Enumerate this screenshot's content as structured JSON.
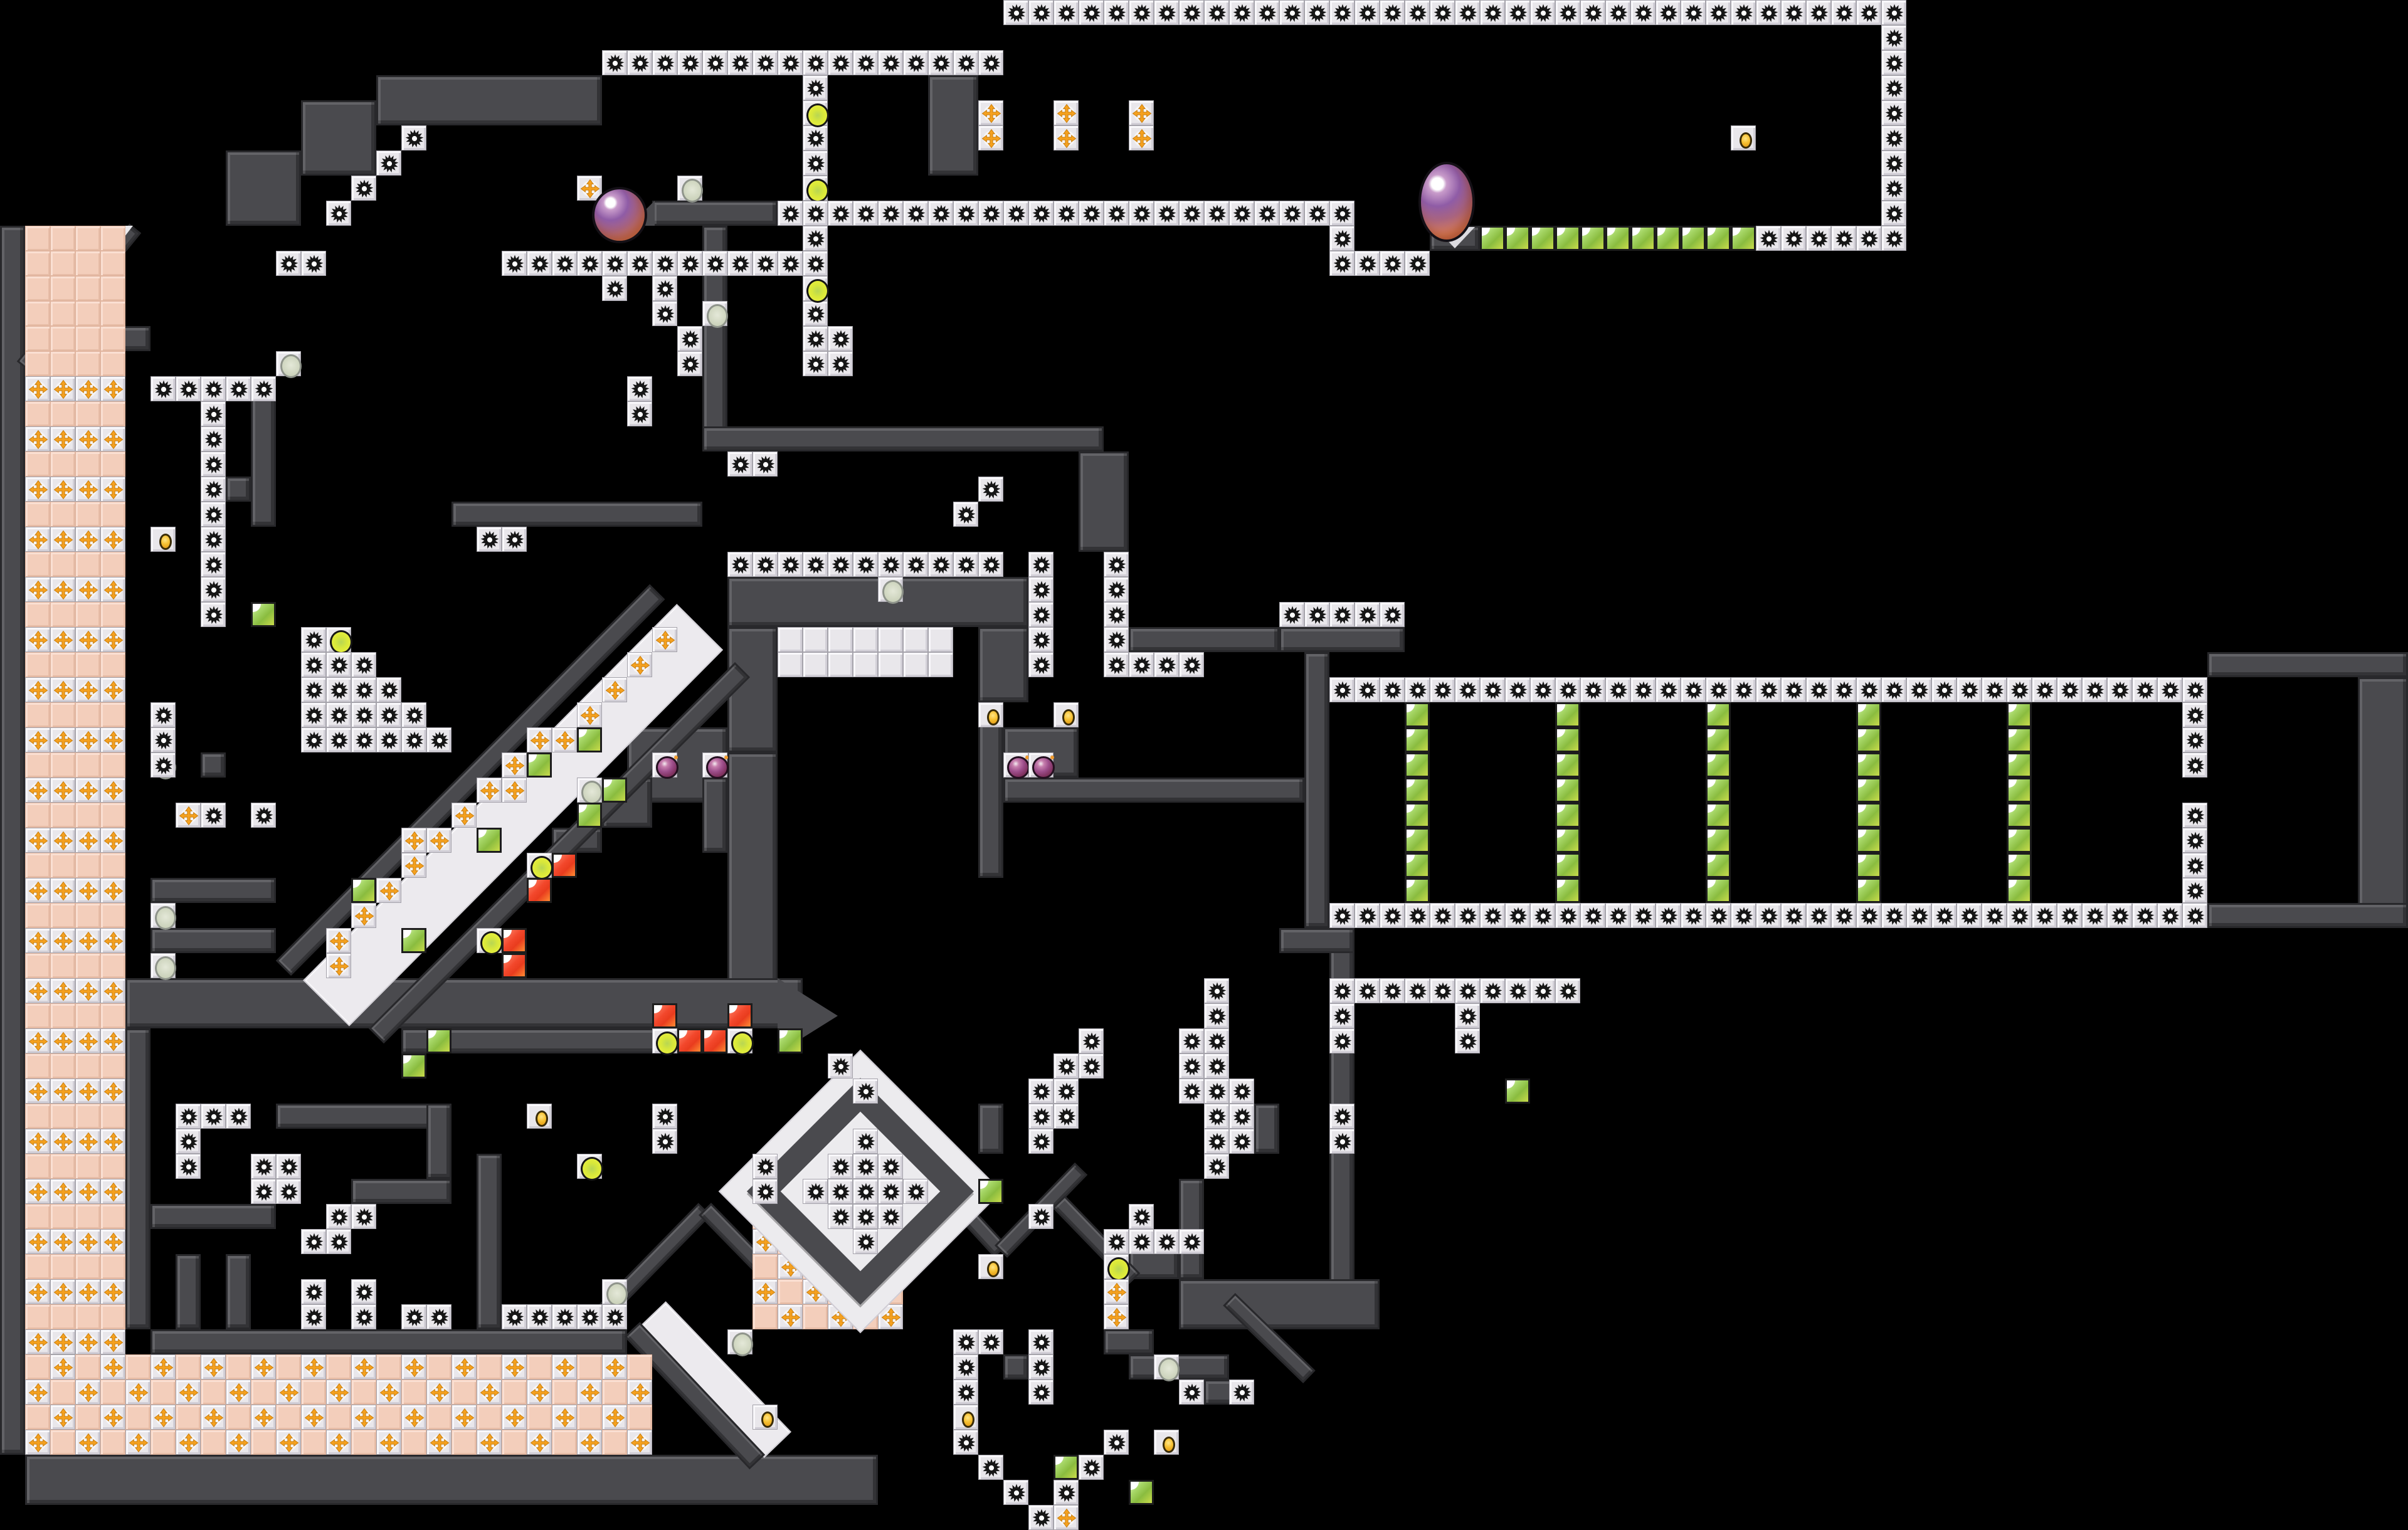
{
  "map": {
    "tile_size": 40,
    "grid": {
      "cols": 96,
      "rows": 61
    },
    "colors": {
      "background": "#000000",
      "wall": "#4a4a4e",
      "wall_edge": "#28282b",
      "tile_base": "#e9e7eb",
      "gear": "#161616",
      "pink": "#f3cebb",
      "cross": "#f5a11f",
      "green_block": "#8abc3f",
      "red_block": "#ee3b22",
      "yellow_orb": "#e3ee3b",
      "gray_orb": "#ccd3bc",
      "gold_item": "#f6c133",
      "plum_enemy": "#9c4d8a",
      "big_orb_purple": "#8f5ca6",
      "big_orb_orange": "#dd7f58"
    },
    "legend": {
      "g": "gear-block-tile",
      "w": "white-tile",
      "pk": "pink-tile",
      "p": "cross-spike-tile",
      "gr": "green-item-block",
      "rd": "red-item-block",
      "yo": "yellow-orb-tile",
      "so": "gray-orb-tile",
      "gd": "gold-item-tile",
      "pl": "plum-enemy-tile"
    },
    "walls": [
      [
        15,
        3,
        9,
        2
      ],
      [
        12,
        4,
        3,
        3
      ],
      [
        9,
        6,
        3,
        3
      ],
      [
        37,
        3,
        2,
        4
      ],
      [
        26,
        8,
        5,
        1
      ],
      [
        57,
        9,
        2,
        1
      ],
      [
        28,
        9,
        1,
        9
      ],
      [
        28,
        17,
        16,
        1
      ],
      [
        43,
        18,
        2,
        4
      ],
      [
        18,
        20,
        10,
        1
      ],
      [
        29,
        23,
        12,
        2
      ],
      [
        29,
        25,
        2,
        5
      ],
      [
        39,
        25,
        2,
        3
      ],
      [
        29,
        30,
        2,
        10
      ],
      [
        25,
        29,
        4,
        3
      ],
      [
        28,
        31,
        1,
        3
      ],
      [
        39,
        28,
        1,
        7
      ],
      [
        40,
        29,
        3,
        2
      ],
      [
        40,
        31,
        12,
        1
      ],
      [
        45,
        25,
        6,
        1
      ],
      [
        51,
        25,
        5,
        1
      ],
      [
        52,
        26,
        1,
        11
      ],
      [
        88,
        26,
        8,
        1
      ],
      [
        94,
        27,
        2,
        10
      ],
      [
        88,
        36,
        8,
        1
      ],
      [
        53,
        37,
        1,
        15
      ],
      [
        51,
        37,
        3,
        1
      ],
      [
        47,
        51,
        8,
        2
      ],
      [
        47,
        47,
        1,
        4
      ],
      [
        45,
        49,
        2,
        2
      ],
      [
        5,
        39,
        27,
        2
      ],
      [
        16,
        41,
        14,
        1
      ],
      [
        0,
        9,
        1,
        49
      ],
      [
        2,
        13,
        4,
        1
      ],
      [
        10,
        15,
        1,
        6
      ],
      [
        9,
        19,
        1,
        1
      ],
      [
        8,
        30,
        1,
        1
      ],
      [
        6,
        35,
        5,
        1
      ],
      [
        6,
        37,
        5,
        1
      ],
      [
        6,
        53,
        19,
        1
      ],
      [
        7,
        50,
        1,
        3
      ],
      [
        9,
        50,
        1,
        3
      ],
      [
        1,
        58,
        34,
        2
      ],
      [
        11,
        44,
        7,
        1
      ],
      [
        17,
        44,
        1,
        3
      ],
      [
        14,
        47,
        4,
        1
      ],
      [
        5,
        41,
        1,
        12
      ],
      [
        6,
        48,
        5,
        1
      ],
      [
        19,
        46,
        1,
        7
      ],
      [
        24,
        31,
        2,
        2
      ],
      [
        22,
        33,
        2,
        1
      ],
      [
        38,
        47,
        1,
        1
      ],
      [
        40,
        54,
        1,
        1
      ],
      [
        44,
        53,
        2,
        1
      ],
      [
        45,
        54,
        4,
        1
      ],
      [
        48,
        55,
        2,
        1
      ],
      [
        39,
        44,
        1,
        2
      ],
      [
        50,
        44,
        1,
        2
      ]
    ],
    "diagonals": [
      {
        "x1": 13.0,
        "y1": 40.0,
        "x2": 27.9,
        "y2": 25.0,
        "th": 2.6,
        "c": "white"
      },
      {
        "x1": 11.3,
        "y1": 38.6,
        "x2": 26.2,
        "y2": 23.6,
        "th": 0.85
      },
      {
        "x1": 15.0,
        "y1": 41.3,
        "x2": 29.6,
        "y2": 26.7,
        "th": 0.85
      },
      {
        "x1": 26.0,
        "y1": 52.4,
        "x2": 31.0,
        "y2": 57.6,
        "th": 1.5,
        "c": "white"
      },
      {
        "x1": 25.2,
        "y1": 53.0,
        "x2": 30.2,
        "y2": 58.3,
        "th": 0.85
      },
      {
        "x1": 0.9,
        "y1": 14.6,
        "x2": 5.4,
        "y2": 9.1,
        "th": 0.6
      },
      {
        "x1": 23.6,
        "y1": 52.8,
        "x2": 28.1,
        "y2": 48.2,
        "th": 0.7
      },
      {
        "x1": 28.1,
        "y1": 48.2,
        "x2": 32.4,
        "y2": 52.6,
        "th": 0.7
      },
      {
        "x1": 36.6,
        "y1": 46.3,
        "x2": 39.9,
        "y2": 49.9,
        "th": 0.7
      },
      {
        "x1": 39.9,
        "y1": 49.9,
        "x2": 43.1,
        "y2": 46.6,
        "th": 0.7
      },
      {
        "x1": 49.0,
        "y1": 51.8,
        "x2": 52.2,
        "y2": 54.9,
        "th": 0.7
      },
      {
        "x1": 42.2,
        "y1": 47.9,
        "x2": 45.2,
        "y2": 51.0,
        "th": 0.7
      }
    ],
    "triangles": [
      {
        "x": 1,
        "y": 9,
        "w": 4.3,
        "h": 5.6,
        "clip": "polygon(0 0,100% 0,0 100%)",
        "c": "#ecebee"
      },
      {
        "x": 57.2,
        "y": 9.05,
        "w": 1.6,
        "h": 0.85,
        "clip": "polygon(0 0,100% 0,50% 100%)",
        "c": "#dcdbe0"
      },
      {
        "x": 31,
        "y": 39,
        "w": 2.4,
        "h": 3,
        "clip": "polygon(0 0,100% 50%,0 100%)",
        "c": "#4a4a4e"
      },
      {
        "x": 25.1,
        "y": 8,
        "w": 1,
        "h": 1,
        "clip": "polygon(100% 0,100% 100%,0 100%)",
        "c": "#4a4a4e"
      }
    ],
    "pink_column": {
      "x": 1,
      "y": 9,
      "w": 4,
      "h": 45,
      "plus_rows_start": 15,
      "plus_rows_step": 2
    },
    "checkers": [
      {
        "x": 1,
        "y": 54,
        "w": 25,
        "h": 4,
        "phase": 0
      },
      {
        "x": 30,
        "y": 48,
        "w": 6,
        "h": 5,
        "phase": 1
      }
    ],
    "diamond": {
      "cx": 34.3,
      "cy": 47.5,
      "back": 8.0,
      "ring": 6.4,
      "ring_border": 0.95
    },
    "tiles": [
      [
        "g",
        40,
        0,
        36,
        "h"
      ],
      [
        "g",
        75,
        1,
        8,
        "v"
      ],
      [
        "g",
        24,
        2,
        16,
        "h"
      ],
      [
        "g",
        32,
        3,
        12,
        "v"
      ],
      [
        "yo",
        32,
        4
      ],
      [
        "yo",
        32,
        7
      ],
      [
        "yo",
        32,
        11
      ],
      [
        "g",
        33,
        13,
        2,
        "v"
      ],
      [
        "p",
        39,
        4
      ],
      [
        "p",
        39,
        5
      ],
      [
        "p",
        42,
        4
      ],
      [
        "p",
        42,
        5
      ],
      [
        "p",
        45,
        4
      ],
      [
        "p",
        45,
        5
      ],
      [
        "gd",
        69,
        5
      ],
      [
        "g",
        31,
        8,
        23,
        "h"
      ],
      [
        "g",
        53,
        9
      ],
      [
        "g",
        53,
        10,
        4,
        "h"
      ],
      [
        "gr",
        59,
        9,
        11,
        "h"
      ],
      [
        "g",
        70,
        9,
        6,
        "h"
      ],
      [
        "g",
        16,
        5
      ],
      [
        "g",
        15,
        6
      ],
      [
        "g",
        14,
        7
      ],
      [
        "g",
        13,
        8
      ],
      [
        "g",
        11,
        10,
        2,
        "h"
      ],
      [
        "p",
        23,
        7
      ],
      [
        "so",
        27,
        7
      ],
      [
        "g",
        20,
        10,
        12,
        "h"
      ],
      [
        "g",
        24,
        11
      ],
      [
        "g",
        26,
        11,
        2,
        "v"
      ],
      [
        "g",
        27,
        13,
        2,
        "v"
      ],
      [
        "g",
        25,
        15,
        2,
        "v"
      ],
      [
        "so",
        28,
        12
      ],
      [
        "g",
        29,
        18,
        2,
        "h"
      ],
      [
        "g",
        19,
        21,
        2,
        "h"
      ],
      [
        "g",
        38,
        20
      ],
      [
        "g",
        39,
        19
      ],
      [
        "so",
        35,
        23
      ],
      [
        "g",
        29,
        22,
        11,
        "h"
      ],
      [
        "w",
        31,
        25,
        7,
        "h"
      ],
      [
        "w",
        31,
        26,
        7,
        "h"
      ],
      [
        "g",
        41,
        22,
        5,
        "v"
      ],
      [
        "g",
        44,
        22,
        5,
        "v"
      ],
      [
        "g",
        45,
        26,
        3,
        "h"
      ],
      [
        "g",
        51,
        24,
        5,
        "h"
      ],
      [
        "gd",
        39,
        28
      ],
      [
        "gd",
        42,
        28
      ],
      [
        "pl",
        26,
        30
      ],
      [
        "pl",
        28,
        30
      ],
      [
        "pl",
        40,
        30
      ],
      [
        "pl",
        41,
        30
      ],
      [
        "g",
        53,
        27,
        35,
        "h"
      ],
      [
        "g",
        53,
        36,
        35,
        "h"
      ],
      [
        "gr",
        56,
        28,
        8,
        "v"
      ],
      [
        "gr",
        62,
        28,
        8,
        "v"
      ],
      [
        "gr",
        68,
        28,
        8,
        "v"
      ],
      [
        "gr",
        74,
        28,
        8,
        "v"
      ],
      [
        "gr",
        80,
        28,
        8,
        "v"
      ],
      [
        "g",
        87,
        28,
        3,
        "v"
      ],
      [
        "g",
        87,
        32,
        4,
        "v"
      ],
      [
        "g",
        53,
        39,
        10,
        "h"
      ],
      [
        "g",
        53,
        40,
        2,
        "v"
      ],
      [
        "g",
        58,
        40,
        2,
        "v"
      ],
      [
        "g",
        53,
        44,
        2,
        "v"
      ],
      [
        "gr",
        60,
        43
      ],
      [
        "g",
        48,
        39,
        2,
        "v"
      ],
      [
        "g",
        43,
        41
      ],
      [
        "g",
        47,
        41
      ],
      [
        "g",
        48,
        41
      ],
      [
        "g",
        42,
        42
      ],
      [
        "g",
        43,
        42
      ],
      [
        "g",
        47,
        42
      ],
      [
        "g",
        48,
        42
      ],
      [
        "g",
        41,
        43
      ],
      [
        "g",
        42,
        43
      ],
      [
        "g",
        47,
        43
      ],
      [
        "g",
        48,
        43
      ],
      [
        "g",
        49,
        43
      ],
      [
        "g",
        41,
        44
      ],
      [
        "g",
        42,
        44
      ],
      [
        "g",
        48,
        44
      ],
      [
        "g",
        49,
        44
      ],
      [
        "g",
        41,
        45
      ],
      [
        "g",
        48,
        45
      ],
      [
        "g",
        49,
        45
      ],
      [
        "g",
        48,
        46
      ],
      [
        "g",
        41,
        48
      ],
      [
        "g",
        45,
        48
      ],
      [
        "g",
        44,
        49,
        4,
        "h"
      ],
      [
        "yo",
        44,
        50
      ],
      [
        "p",
        44,
        51
      ],
      [
        "p",
        44,
        52
      ],
      [
        "so",
        46,
        54
      ],
      [
        "g",
        47,
        55
      ],
      [
        "g",
        49,
        55
      ],
      [
        "g",
        38,
        53
      ],
      [
        "g",
        39,
        53
      ],
      [
        "g",
        38,
        54
      ],
      [
        "g",
        38,
        55
      ],
      [
        "g",
        41,
        53,
        3,
        "v"
      ],
      [
        "gr",
        42,
        58
      ],
      [
        "gr",
        45,
        59
      ],
      [
        "gd",
        46,
        57
      ],
      [
        "g",
        38,
        57
      ],
      [
        "g",
        39,
        58
      ],
      [
        "g",
        40,
        59
      ],
      [
        "g",
        41,
        60
      ],
      [
        "g",
        42,
        59
      ],
      [
        "g",
        43,
        58
      ],
      [
        "g",
        44,
        57
      ],
      [
        "p",
        42,
        60
      ],
      [
        "gr",
        23,
        29
      ],
      [
        "gr",
        21,
        30
      ],
      [
        "so",
        23,
        31
      ],
      [
        "gr",
        24,
        31
      ],
      [
        "gr",
        23,
        32
      ],
      [
        "gr",
        19,
        33
      ],
      [
        "yo",
        21,
        34
      ],
      [
        "rd",
        22,
        34
      ],
      [
        "rd",
        21,
        35
      ],
      [
        "gr",
        14,
        35
      ],
      [
        "gr",
        16,
        37
      ],
      [
        "yo",
        19,
        37
      ],
      [
        "rd",
        20,
        37
      ],
      [
        "rd",
        20,
        38
      ],
      [
        "gr",
        17,
        41
      ],
      [
        "gr",
        16,
        42
      ],
      [
        "rd",
        26,
        40
      ],
      [
        "rd",
        29,
        40
      ],
      [
        "yo",
        26,
        41
      ],
      [
        "rd",
        27,
        41
      ],
      [
        "rd",
        28,
        41
      ],
      [
        "yo",
        29,
        41
      ],
      [
        "gr",
        31,
        41
      ],
      [
        "gd",
        21,
        44
      ],
      [
        "gd",
        6,
        21
      ],
      [
        "gd",
        30,
        56
      ],
      [
        "gd",
        38,
        56
      ],
      [
        "gd",
        39,
        50
      ],
      [
        "gr",
        39,
        47
      ],
      [
        "so",
        11,
        14
      ],
      [
        "so",
        6,
        30
      ],
      [
        "so",
        6,
        36
      ],
      [
        "so",
        6,
        38
      ],
      [
        "so",
        24,
        51
      ],
      [
        "so",
        29,
        53
      ],
      [
        "g",
        6,
        15,
        5,
        "h"
      ],
      [
        "g",
        8,
        16,
        9,
        "v"
      ],
      [
        "gr",
        10,
        24
      ],
      [
        "g",
        12,
        25
      ],
      [
        "yo",
        13,
        25
      ],
      [
        "g",
        12,
        26,
        3,
        "h"
      ],
      [
        "g",
        12,
        27,
        4,
        "h"
      ],
      [
        "g",
        12,
        28,
        5,
        "h"
      ],
      [
        "g",
        12,
        29,
        6,
        "h"
      ],
      [
        "g",
        6,
        28,
        3,
        "v"
      ],
      [
        "p",
        7,
        32
      ],
      [
        "g",
        8,
        32
      ],
      [
        "g",
        10,
        32
      ],
      [
        "p",
        13,
        37
      ],
      [
        "p",
        13,
        38
      ],
      [
        "p",
        14,
        36
      ],
      [
        "p",
        15,
        35
      ],
      [
        "p",
        16,
        34
      ],
      [
        "p",
        16,
        33
      ],
      [
        "p",
        17,
        33
      ],
      [
        "p",
        18,
        32
      ],
      [
        "p",
        19,
        31
      ],
      [
        "p",
        20,
        31
      ],
      [
        "p",
        20,
        30
      ],
      [
        "p",
        21,
        29
      ],
      [
        "p",
        22,
        29
      ],
      [
        "p",
        23,
        28
      ],
      [
        "p",
        24,
        27
      ],
      [
        "p",
        25,
        26
      ],
      [
        "p",
        26,
        25
      ],
      [
        "g",
        7,
        44,
        3,
        "h"
      ],
      [
        "g",
        7,
        45,
        2,
        "v"
      ],
      [
        "g",
        10,
        46,
        2,
        "h"
      ],
      [
        "g",
        10,
        47,
        2,
        "h"
      ],
      [
        "g",
        13,
        48,
        2,
        "h"
      ],
      [
        "g",
        12,
        49,
        2,
        "h"
      ],
      [
        "yo",
        23,
        46
      ],
      [
        "g",
        12,
        51
      ],
      [
        "g",
        12,
        52
      ],
      [
        "g",
        14,
        51
      ],
      [
        "g",
        14,
        52
      ],
      [
        "g",
        16,
        52,
        2,
        "h"
      ],
      [
        "g",
        20,
        52,
        5,
        "h"
      ],
      [
        "g",
        30,
        46,
        2,
        "v"
      ],
      [
        "g",
        26,
        44,
        2,
        "v"
      ],
      [
        "g",
        33,
        42
      ],
      [
        "g",
        34,
        43
      ],
      [
        "g",
        34,
        45
      ],
      [
        "g",
        33,
        46
      ],
      [
        "g",
        34,
        46
      ],
      [
        "g",
        35,
        46
      ],
      [
        "g",
        32,
        47
      ],
      [
        "g",
        33,
        47
      ],
      [
        "g",
        34,
        47
      ],
      [
        "g",
        35,
        47
      ],
      [
        "g",
        36,
        47
      ],
      [
        "g",
        33,
        48
      ],
      [
        "g",
        34,
        48
      ],
      [
        "g",
        35,
        48
      ],
      [
        "g",
        34,
        49
      ]
    ],
    "orbs": [
      {
        "x": 23.6,
        "y": 7.45,
        "w": 2.0,
        "h": 2.05
      },
      {
        "x": 56.55,
        "y": 6.45,
        "w": 2.05,
        "h": 3.0
      }
    ]
  }
}
